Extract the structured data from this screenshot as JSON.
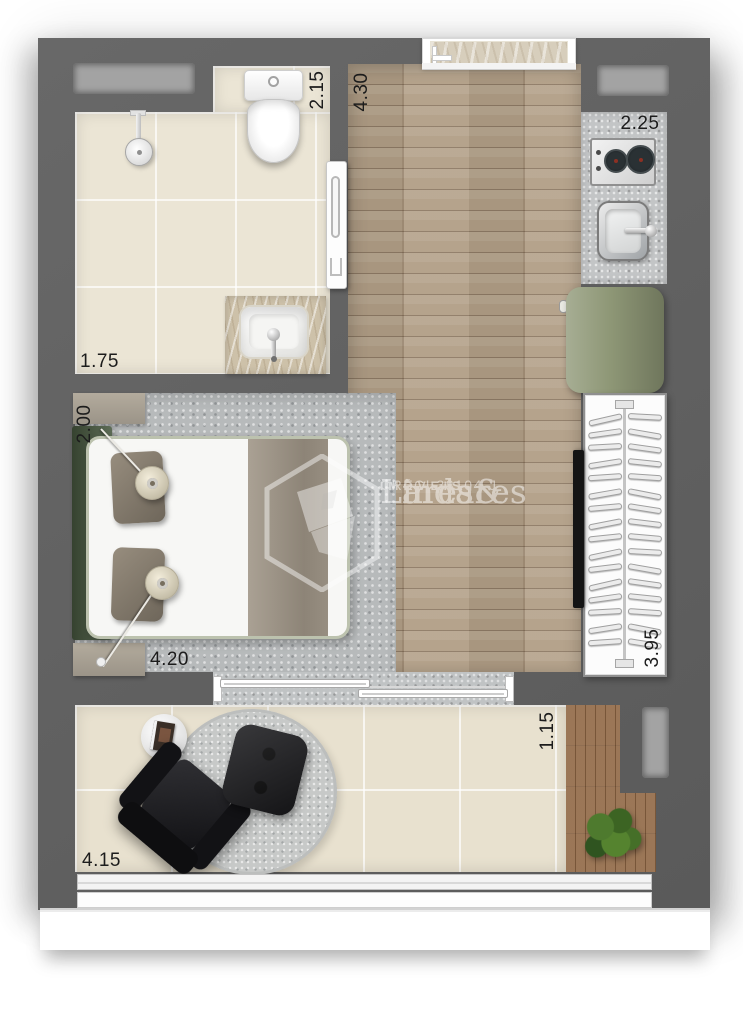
{
  "plan": {
    "dimensions": {
      "bathroom_width": "1.75",
      "bathroom_length": "2.15",
      "living_length": "4.30",
      "kitchen_length": "2.25",
      "bedroom_width": "2.00",
      "bedroom_length": "4.20",
      "closet_length": "3.95",
      "balcony_depth": "1.15",
      "balcony_length": "4.15"
    },
    "closet": {
      "hanger_count": 16
    },
    "kitchen": {
      "burner_count": 2
    },
    "colors": {
      "wall": "#606060",
      "wood_floor": "#b19e86",
      "tile_floor": "#ebe5d5",
      "balcony_tile": "#e8e1cf",
      "rug": "#b7babb",
      "counter": "#c3c5c6",
      "fridge": "#8e9776",
      "headboard_bench": "#47583f",
      "deck_wood": "#996f4c",
      "leather_chair": "#1d1d20"
    }
  },
  "watermark": {
    "brand_line1": "Lares&",
    "brand_line2": "Lindares",
    "subtitle": "IMÓVEIS",
    "license": "CRECI 38104-J"
  }
}
